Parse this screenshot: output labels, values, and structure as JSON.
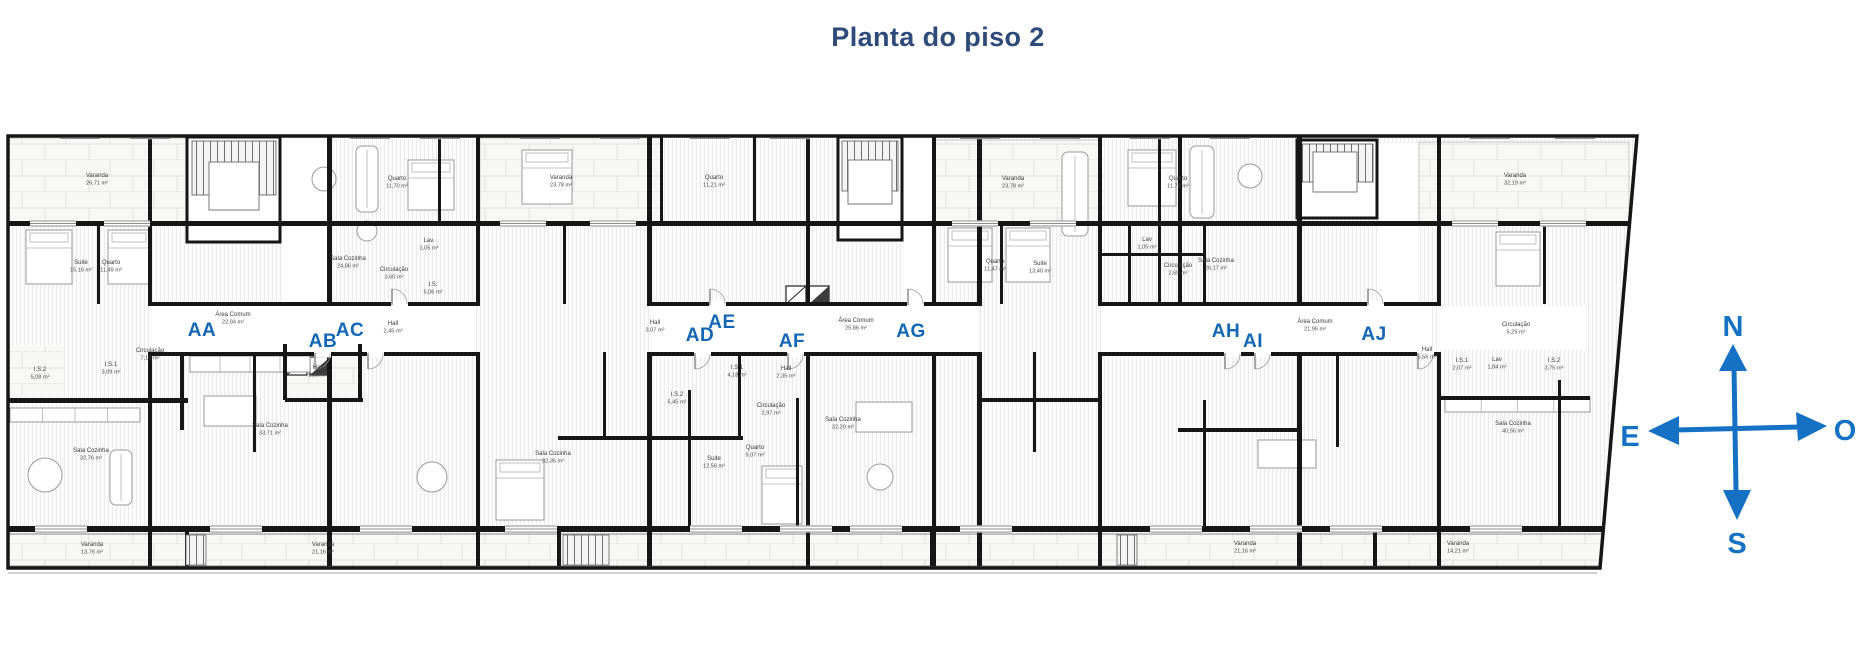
{
  "title": "Planta do piso 2",
  "compass": {
    "north": "N",
    "south": "S",
    "east": "E",
    "west": "O"
  },
  "colors": {
    "accent_blue": "#1467b4",
    "compass_blue": "#1571c3",
    "title_navy": "#2e4a78",
    "wall_black": "#161616"
  },
  "plan": {
    "units": [
      {
        "id": "AA",
        "x": 202,
        "y": 336
      },
      {
        "id": "AB",
        "x": 323,
        "y": 347
      },
      {
        "id": "AC",
        "x": 350,
        "y": 336
      },
      {
        "id": "AD",
        "x": 700,
        "y": 341
      },
      {
        "id": "AE",
        "x": 722,
        "y": 328
      },
      {
        "id": "AF",
        "x": 792,
        "y": 347
      },
      {
        "id": "AG",
        "x": 911,
        "y": 337
      },
      {
        "id": "AH",
        "x": 1226,
        "y": 337
      },
      {
        "id": "AI",
        "x": 1253,
        "y": 347
      },
      {
        "id": "AJ",
        "x": 1374,
        "y": 340
      }
    ],
    "rooms": [
      {
        "name": "Varanda",
        "area": "26,71 m²",
        "x": 97,
        "y": 177
      },
      {
        "name": "Suite",
        "area": "15,16 m²",
        "x": 81,
        "y": 264
      },
      {
        "name": "Quarto",
        "area": "11,49 m²",
        "x": 111,
        "y": 264
      },
      {
        "name": "Quarto",
        "area": "11,70 m²",
        "x": 397,
        "y": 180
      },
      {
        "name": "Sala Cozinha",
        "area": "24,86 m²",
        "x": 348,
        "y": 260
      },
      {
        "name": "Circulação",
        "area": "3,60 m²",
        "x": 394,
        "y": 271
      },
      {
        "name": "Área Comum",
        "area": "22,94 m²",
        "x": 233,
        "y": 316
      },
      {
        "name": "Hall",
        "area": "2,45 m²",
        "x": 393,
        "y": 325
      },
      {
        "name": "Lav.",
        "area": "1,05 m²",
        "x": 429,
        "y": 242
      },
      {
        "name": "I.S.",
        "area": "5,06 m²",
        "x": 433,
        "y": 286
      },
      {
        "name": "I.S.2",
        "area": "5,08 m²",
        "x": 40,
        "y": 371
      },
      {
        "name": "I.S.1",
        "area": "3,09 m²",
        "x": 111,
        "y": 366
      },
      {
        "name": "Circulação",
        "area": "7,13 m²",
        "x": 150,
        "y": 352
      },
      {
        "name": "Sala Cozinha",
        "area": "32,76 m²",
        "x": 91,
        "y": 452
      },
      {
        "name": "Sala Cozinha",
        "area": "33,71 m²",
        "x": 270,
        "y": 427
      },
      {
        "name": "Hall",
        "area": "2,35 m²",
        "x": 318,
        "y": 369
      },
      {
        "name": "Varanda",
        "area": "13,76 m²",
        "x": 92,
        "y": 546
      },
      {
        "name": "Varanda",
        "area": "21,16 m²",
        "x": 323,
        "y": 546
      },
      {
        "name": "Varanda",
        "area": "23,78 m²",
        "x": 561,
        "y": 179
      },
      {
        "name": "Quarto",
        "area": "11,21 m²",
        "x": 714,
        "y": 179
      },
      {
        "name": "Hall",
        "area": "3,07 m²",
        "x": 655,
        "y": 324
      },
      {
        "name": "Área Comum",
        "area": "25,86 m²",
        "x": 856,
        "y": 322
      },
      {
        "name": "I.S.1",
        "area": "4,18 m²",
        "x": 737,
        "y": 369
      },
      {
        "name": "Hall",
        "area": "2,35 m²",
        "x": 786,
        "y": 370
      },
      {
        "name": "I.S.2",
        "area": "5,45 m²",
        "x": 677,
        "y": 396
      },
      {
        "name": "Circulação",
        "area": "2,97 m²",
        "x": 771,
        "y": 407
      },
      {
        "name": "Sala Cozinha",
        "area": "32,35 m²",
        "x": 553,
        "y": 455
      },
      {
        "name": "Suite",
        "area": "12,56 m²",
        "x": 714,
        "y": 460
      },
      {
        "name": "Quarto",
        "area": "9,07 m²",
        "x": 755,
        "y": 449
      },
      {
        "name": "Sala Cozinha",
        "area": "32,20 m²",
        "x": 843,
        "y": 421
      },
      {
        "name": "Varanda",
        "area": "23,78 m²",
        "x": 1013,
        "y": 180
      },
      {
        "name": "Quarto",
        "area": "11,47 m²",
        "x": 995,
        "y": 263
      },
      {
        "name": "Suite",
        "area": "13,40 m²",
        "x": 1040,
        "y": 265
      },
      {
        "name": "Quarto",
        "area": "11,70 m²",
        "x": 1178,
        "y": 180
      },
      {
        "name": "Lav",
        "area": "1,05 m²",
        "x": 1147,
        "y": 241
      },
      {
        "name": "Circulação",
        "area": "2,69 m²",
        "x": 1178,
        "y": 267
      },
      {
        "name": "Sala Cozinha",
        "area": "26,17 m²",
        "x": 1216,
        "y": 262
      },
      {
        "name": "Área Comum",
        "area": "21,96 m²",
        "x": 1315,
        "y": 323
      },
      {
        "name": "Hall",
        "area": "5,56 m²",
        "x": 1427,
        "y": 351
      },
      {
        "name": "I.S.1",
        "area": "2,07 m²",
        "x": 1462,
        "y": 362
      },
      {
        "name": "Lav",
        "area": "1,84 m²",
        "x": 1497,
        "y": 361
      },
      {
        "name": "I.S.2",
        "area": "3,75 m²",
        "x": 1554,
        "y": 362
      },
      {
        "name": "Circulação",
        "area": "5,29 m²",
        "x": 1516,
        "y": 326
      },
      {
        "name": "Sala Cozinha",
        "area": "40,56 m²",
        "x": 1513,
        "y": 425
      },
      {
        "name": "Varanda",
        "area": "32,19 m²",
        "x": 1515,
        "y": 177
      },
      {
        "name": "Varanda",
        "area": "21,16 m²",
        "x": 1245,
        "y": 545
      },
      {
        "name": "Varanda",
        "area": "14,21 m²",
        "x": 1458,
        "y": 545
      }
    ]
  }
}
